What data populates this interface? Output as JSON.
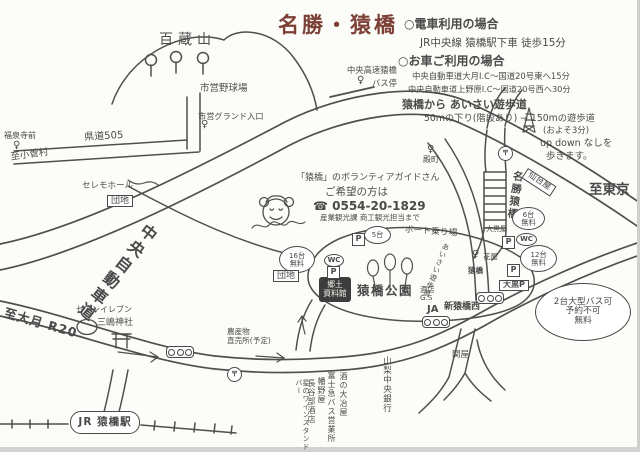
{
  "colors": {
    "ink": "#4a4a4a",
    "title": "#7d4036",
    "paper": "#fcfcf9"
  },
  "labels": {
    "title": "名勝・猿橋",
    "mt": "百蔵山",
    "train_header": "○電車利用の場合",
    "train_line": "JR中央線 猿橋駅下車 徒歩15分",
    "car_header": "○お車ご利用の場合",
    "car_line1": "中央自動車道大月I.C～国道20号東へ15分",
    "car_line2": "中央自動車道上野原I.C～国道20号西へ30分",
    "walk_header": "猿橋から あいさい遊歩道",
    "walk_line": "50mの下り(階段あり) → 150mの遊歩道",
    "walk_time": "(およそ3分)",
    "walk_note1": "up down なしを",
    "walk_note2": "歩きます。",
    "to_tokyo": "至東京",
    "hwy_bus_name": "中央高速猿橋",
    "hwy_bus_stop": "バス停",
    "ballpark": "市営野球場",
    "ground_bus": "市営グランド入口",
    "kendo505": "県道505",
    "fukusenji": "福泉寺前",
    "to_kosuge": "至小菅村",
    "ceremo": "セレモホール",
    "danchi_left": "団地",
    "chuo_expwy": "中央自動車道",
    "vol1": "「猿橋」のボランティアガイドさん",
    "vol2": "ご希望の方は",
    "vol_tel": "☎ 0554-20-1829",
    "vol3": "産業観光課 商工観光担当まで",
    "tonomachi": "殿町",
    "meisho": "名勝猿橋",
    "sendaiya": "仙台屋",
    "bubble6": [
      "6台",
      "無料"
    ],
    "daikokuya": "大黒屋",
    "bubble12": [
      "12台",
      "無料"
    ],
    "hanaya": "花屋",
    "sarubus": "猿橋",
    "boat": "ボート乗り場",
    "bubble5": "5台",
    "bubble16": [
      "16台",
      "無料"
    ],
    "danchi_mid": "団地",
    "kyodo": [
      "郷土",
      "資料館"
    ],
    "park": "猿橋公園",
    "nousan": [
      "農産物",
      "直売所(予定)"
    ],
    "shop1": "酒の大冶屋",
    "shop2": "富士急バス営業所",
    "shop3": "幡野屋",
    "shop4": "長谷部酒店",
    "shop5": "星のワインスタンドバー",
    "jr_station": "JR 猿橋駅",
    "mishima": "三嶋神社",
    "seven": "セブンイレブン",
    "to_otsuki": "至大月 R20",
    "ja": "JA",
    "shinsaru": "新猿橋西",
    "gs": [
      "酒店",
      "G.S"
    ],
    "daikoku_p": "大黒P",
    "bus_bubble": [
      "2台大型バス可",
      "予約不可",
      "無料"
    ],
    "bank": "山梨中央銀行",
    "sekiya": "関屋",
    "aisai": "あいさい遊歩道"
  },
  "icons": {
    "bus_stop": "♀",
    "post_office": "〒",
    "parking": "P",
    "wc": "WC",
    "traffic_signal": "○○○"
  }
}
